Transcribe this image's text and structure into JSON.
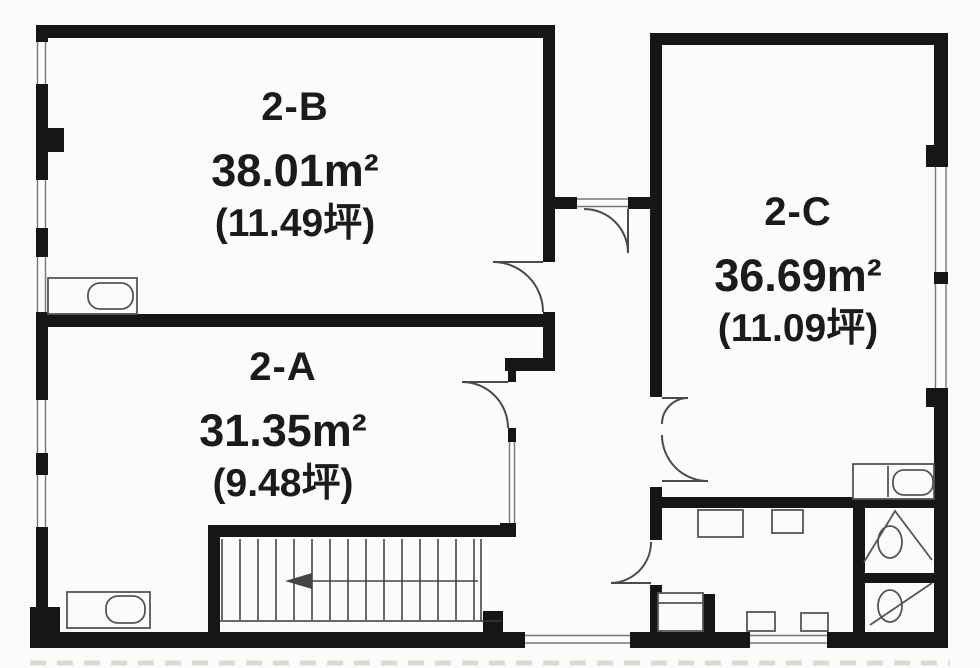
{
  "plan": {
    "floor": "2F",
    "rooms": [
      {
        "name": "2-B",
        "area_m2": "38.01m²",
        "area_tsubo": "(11.49坪)"
      },
      {
        "name": "2-A",
        "area_m2": "31.35m²",
        "area_tsubo": "(9.48坪)"
      },
      {
        "name": "2-C",
        "area_m2": "36.69m²",
        "area_tsubo": "(11.09坪)"
      }
    ],
    "staircase": {
      "arrow_direction": "left"
    },
    "fixtures": [
      "sink-2b",
      "sink-2a",
      "sink-2c",
      "kitchen-counter",
      "kitchen-cabinets",
      "toilet-upper-stall",
      "toilet-lower-stall",
      "staircase"
    ],
    "colors": {
      "background": "#fbfbf9",
      "wall": "#161616",
      "thin_line": "#555555",
      "frame_line": "#777777",
      "text": "#1b1b1b"
    }
  }
}
